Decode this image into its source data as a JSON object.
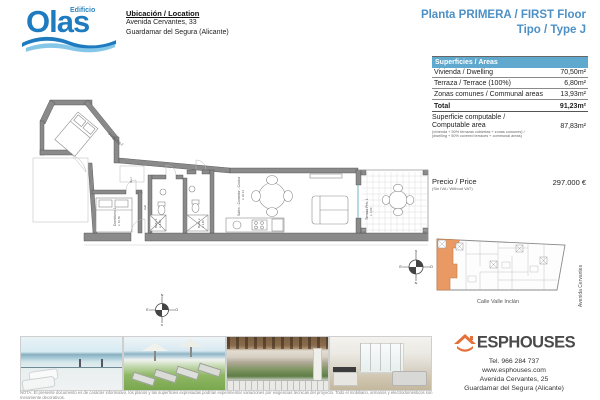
{
  "logo": {
    "top": "Edificio",
    "main": "Olas"
  },
  "location": {
    "title": "Ubicación / Location",
    "address1": "Avenida Cervantes, 33",
    "address2": "Guardamar del Segura (Alicante)"
  },
  "plan_title": {
    "line1": "Planta PRIMERA / FIRST Floor",
    "line2": "Tipo / Type J",
    "color": "#4D90C5"
  },
  "areas_table": {
    "header": "Superficies / Areas",
    "header_bg": "#5FA8CE",
    "rows": [
      {
        "label": "Vivienda / Dwelling",
        "value": "70,50m²"
      },
      {
        "label": "Terraza / Terrace (100%)",
        "value": "6,80m²"
      },
      {
        "label": "Zonas comunes / Communal areas",
        "value": "13,93m²"
      }
    ],
    "total": {
      "label": "Total",
      "value": "91,23m²"
    },
    "computable": {
      "label_line1": "Superficie computable /",
      "label_line2": "Computable area",
      "note_line1": "(vivienda + 50% terrazas cubiertas + zonas comunes) /",
      "note_line2": "(dwelling + 50% covered terraces + communal areas)",
      "value": "87,83m²"
    }
  },
  "price": {
    "label": "Precio / Price",
    "note": "(Sin IVA / Without VAT)",
    "value": "297.000 €"
  },
  "floor_plan": {
    "rooms": {
      "dormitorio1": "Dormitorio 1",
      "dormitorio1_area": "s: 10,56",
      "dormitorio2": "Dormitorio 2",
      "dormitorio2_area": "s: 10,50",
      "bano1": "Baño 1",
      "bano1_area": "s: 3,60",
      "bano2": "Baño 2",
      "bano2_area": "s: 3,60",
      "hall": "Hall",
      "via": "Via J",
      "salon": "Salón - Comedor - Cocina",
      "salon_area": "s: 26,13",
      "terraza": "Terraza Priv. 1",
      "terraza_area": "s: 6,80"
    },
    "wall_color": "#8a8a8a"
  },
  "site_plan": {
    "street_bottom": "Calle Valle Inclán",
    "street_right": "Avenida Cervantes",
    "highlight_color": "#E99A64"
  },
  "compass": {
    "n": "N",
    "s": "S",
    "e": "E",
    "w": "O"
  },
  "photos": [
    {
      "name": "infinity-pool-sea-view"
    },
    {
      "name": "sun-loungers-parasols-sea-view"
    },
    {
      "name": "balcony-pergola-street-view"
    },
    {
      "name": "living-room-kitchen-interior"
    }
  ],
  "footer": {
    "nota_line1": "NOTA: El presente documento es de carácter informativo, los planos y las superficies expresadas podrían experimentar variaciones por exigencias técnicas del proyecto. Todo el mobiliario, armarios y electrodomésticos son meramente decorativos.",
    "nota_line2": "Documento no contractual / This document is for information purposes only and is not contractual."
  },
  "agency": {
    "name": "ESPHOUSES",
    "tel": "Tel. 966 284 737",
    "web": "www.esphouses.com",
    "address1": "Avenida Cervantes, 25",
    "address2": "Guardamar del Segura (Alicante)",
    "brand_color": "#E5703A"
  }
}
